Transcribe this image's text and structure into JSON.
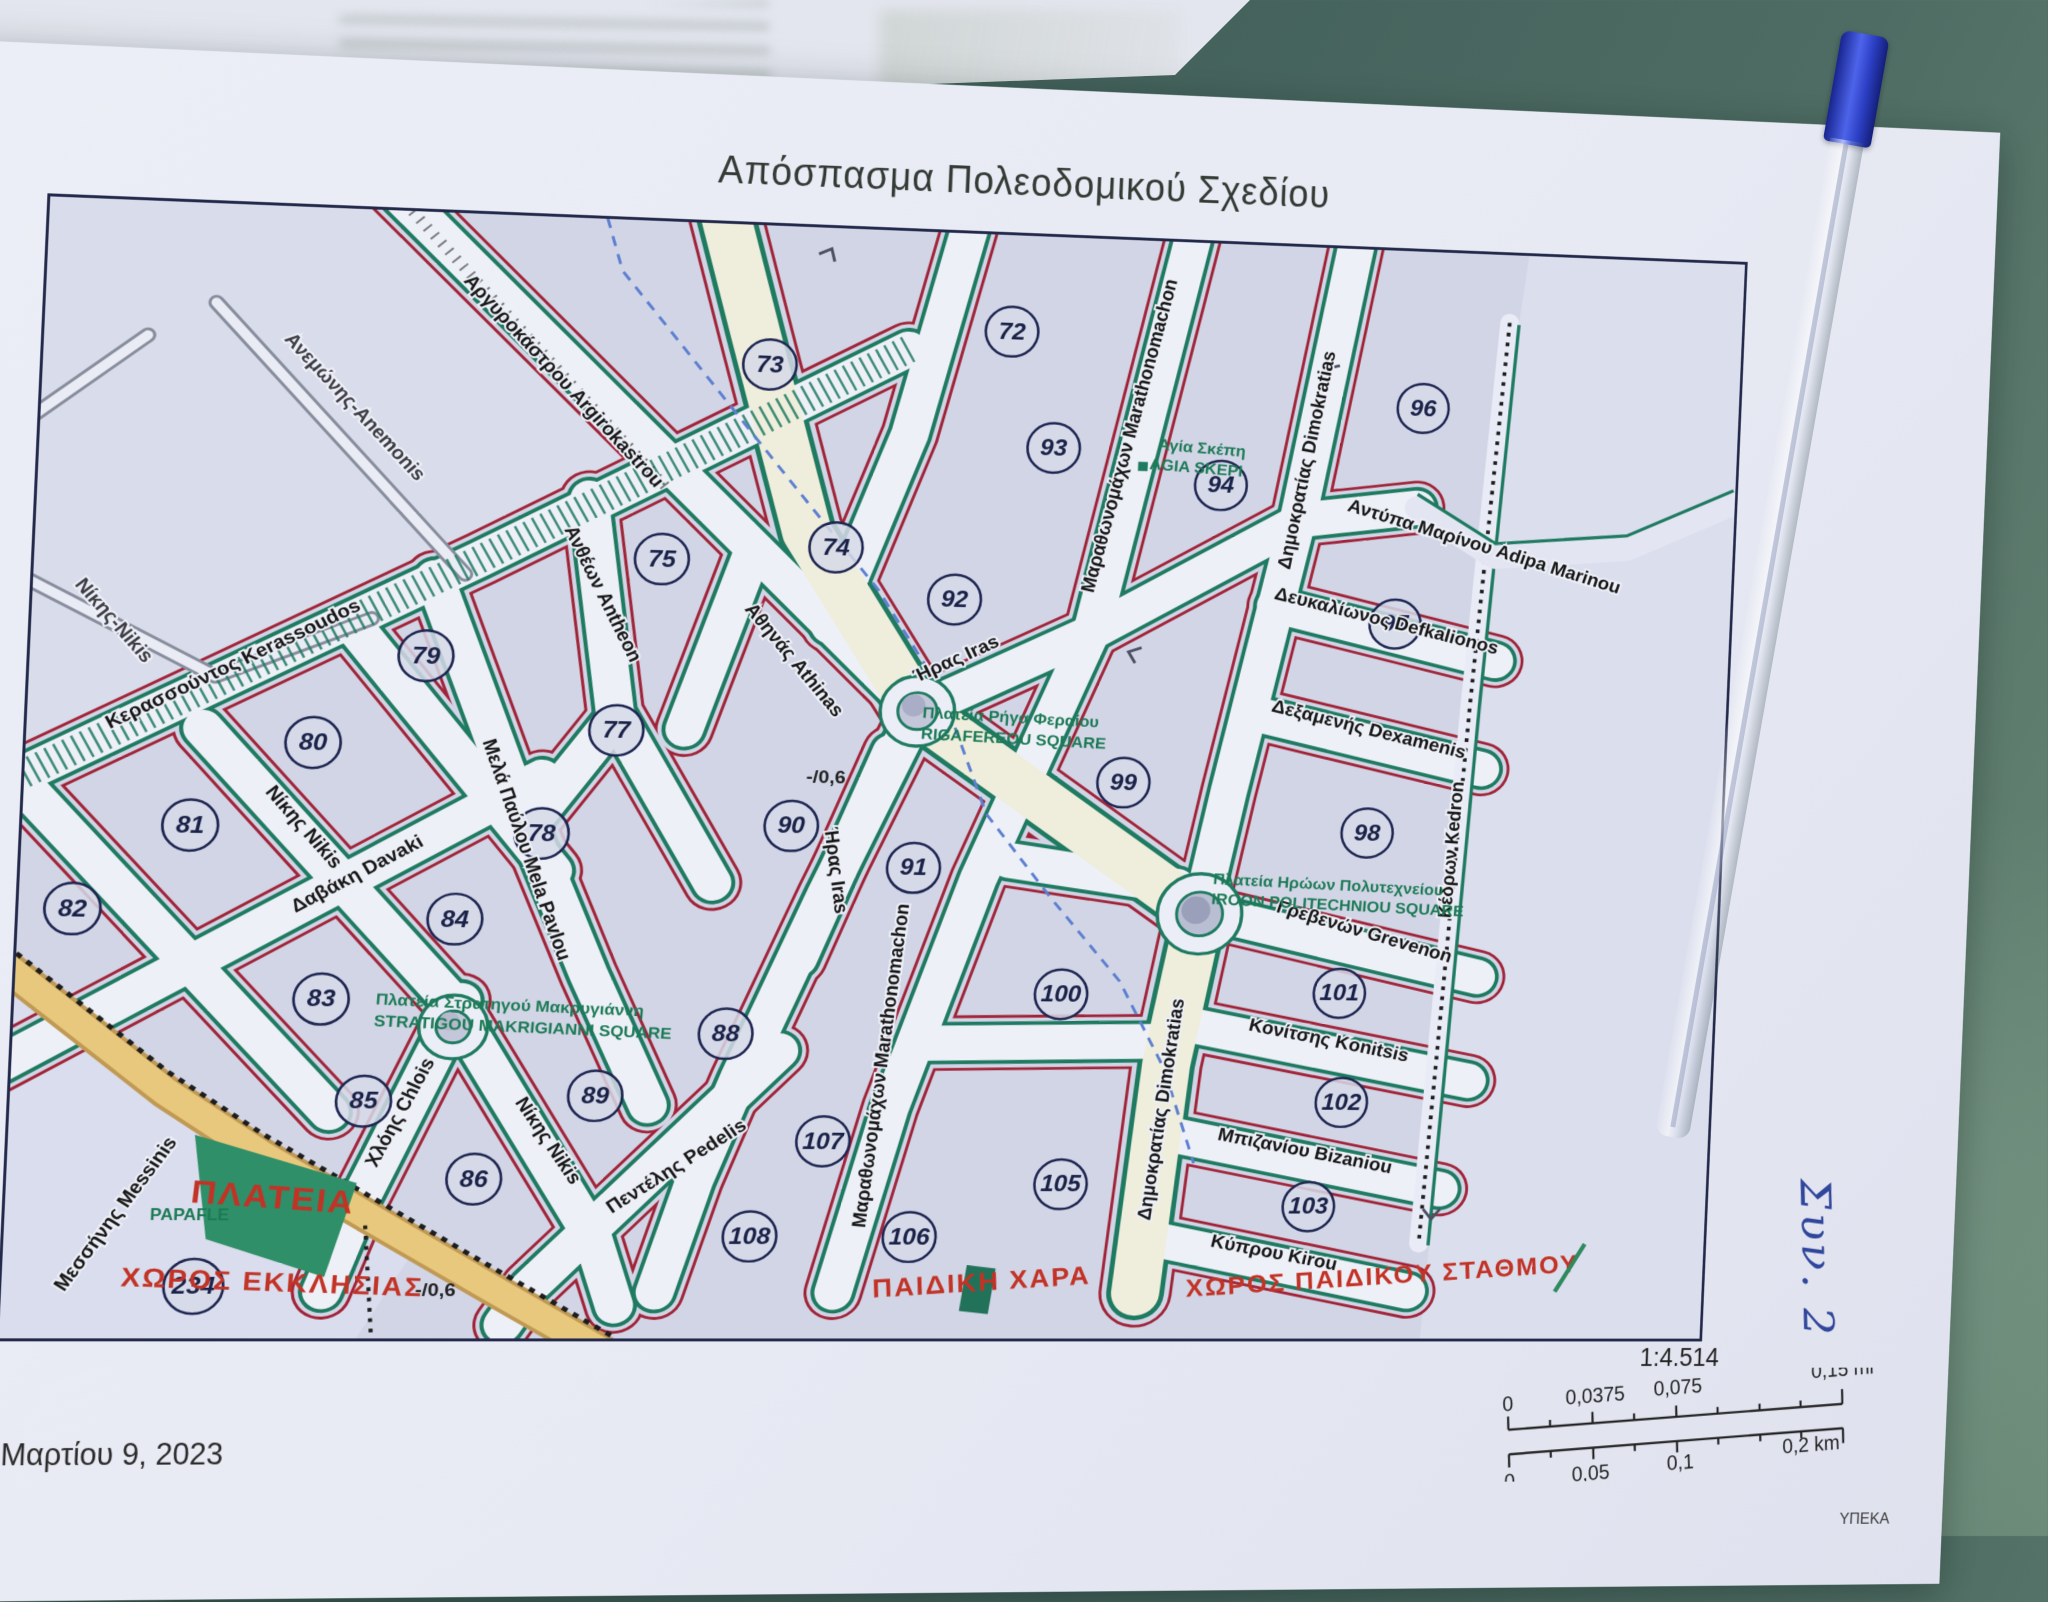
{
  "photo": {
    "handwritten_note": "Συν. 2",
    "objects": {
      "pen": "blue-ballpoint-pen",
      "table": "teal-table-surface",
      "backing_sheet": "white-paper"
    },
    "colors": {
      "map_green": "#1e7a60",
      "map_red": "#a02438",
      "table_teal": "#44625c",
      "plateia_green": "#2f8f68",
      "road_tan": "#e8c87c",
      "pen_blue": "#2b3fd0",
      "boundary_blue": "#5c7fd0",
      "paper": "#e8eaf4"
    }
  },
  "document": {
    "title": "Απόσπασμα Πολεοδομικού Σχεδίου",
    "date": "Μαρτίου 9, 2023",
    "agency": "ΥΠΕΚΑ",
    "scale": {
      "ratio": "1:4.514",
      "mi_ticks": [
        "0",
        "0,0375",
        "0,075"
      ],
      "mi_end": "0,15 mi",
      "km_ticks": [
        "0",
        "0,05",
        "0,1"
      ],
      "km_end": "0,2 km"
    }
  },
  "map": {
    "block_numbers": [
      "72",
      "73",
      "74",
      "75",
      "77",
      "78",
      "79",
      "80",
      "81",
      "82",
      "83",
      "84",
      "85",
      "86",
      "88",
      "89",
      "90",
      "91",
      "92",
      "93",
      "94",
      "96",
      "97",
      "98",
      "99",
      "100",
      "101",
      "102",
      "103",
      "105",
      "106",
      "107",
      "108",
      "234"
    ],
    "street_labels": [
      "Ανεμώνης-Anemonis",
      "Νίκης-Nikis",
      "Κερασσούντος Kerassoudos",
      "Αργυροκάστρου Argirokastrou",
      "Ανθέων Antheon",
      "Αθηνάς Athinas",
      "Ήρας Iras",
      "Ήρας Iras",
      "Μαραθωνομάχων Marathonomachon",
      "Μαραθωνομάχων Marathonomachon",
      "Δημοκρατίας Dimokratias",
      "Δημοκρατίας Dimokratias",
      "Αντύπα Μαρίνου Adipa Marinou",
      "Δευκαλίωνος Defkalionos",
      "Δεξαμενής Dexamenis",
      "Κέδρων Kedron",
      "Γρεβενών Grevenon",
      "Κονίτσης Konitsis",
      "Μπιζανίου Bizaniou",
      "Κύπρου Kirou",
      "Νίκης Nikis",
      "Νίκης Nikis",
      "Δαβάκη Davaki",
      "Μελά Παύλου Mela Pavlou",
      "Χλόης Chlois",
      "Πεντέλης Pedelis",
      "Μεσσήνης Messinis"
    ],
    "squares": {
      "rigafereou": {
        "gr": "Πλατεία Ρήγα Φεραίου",
        "en": "RIGAFEREOU SQUARE"
      },
      "makrigianni": {
        "gr": "Πλατεία Στρατηγού Μακρυγιάννη",
        "en": "STRATIGOU MAKRIGIANNI SQUARE"
      },
      "politechniou": {
        "gr": "Πλατεία Ηρώων Πολυτεχνείου",
        "en": "IROON POLITECHNIOU SQUARE"
      },
      "agia_skepi": {
        "gr": "Αγία Σκέπη",
        "en": "AGIA SKEPI"
      },
      "papaflessa_fragment": "PAPAFLE"
    },
    "red_areas": {
      "plateia": "ΠΛΑΤΕΙΑ",
      "ekklisias": "ΧΩΡΟΣ ΕΚΚΛΗΣΙΑΣ",
      "paidiki_chara": "ΠΑΙΔΙΚΗ ΧΑΡΑ",
      "paidikou_stathmou": "ΧΩΡΟΣ ΠΑΙΔΙΚΟΥ ΣΤΑΘΜΟΥ"
    },
    "annotations": {
      "ratio1": "-/0,6",
      "ratio2": "-/0,6"
    }
  }
}
